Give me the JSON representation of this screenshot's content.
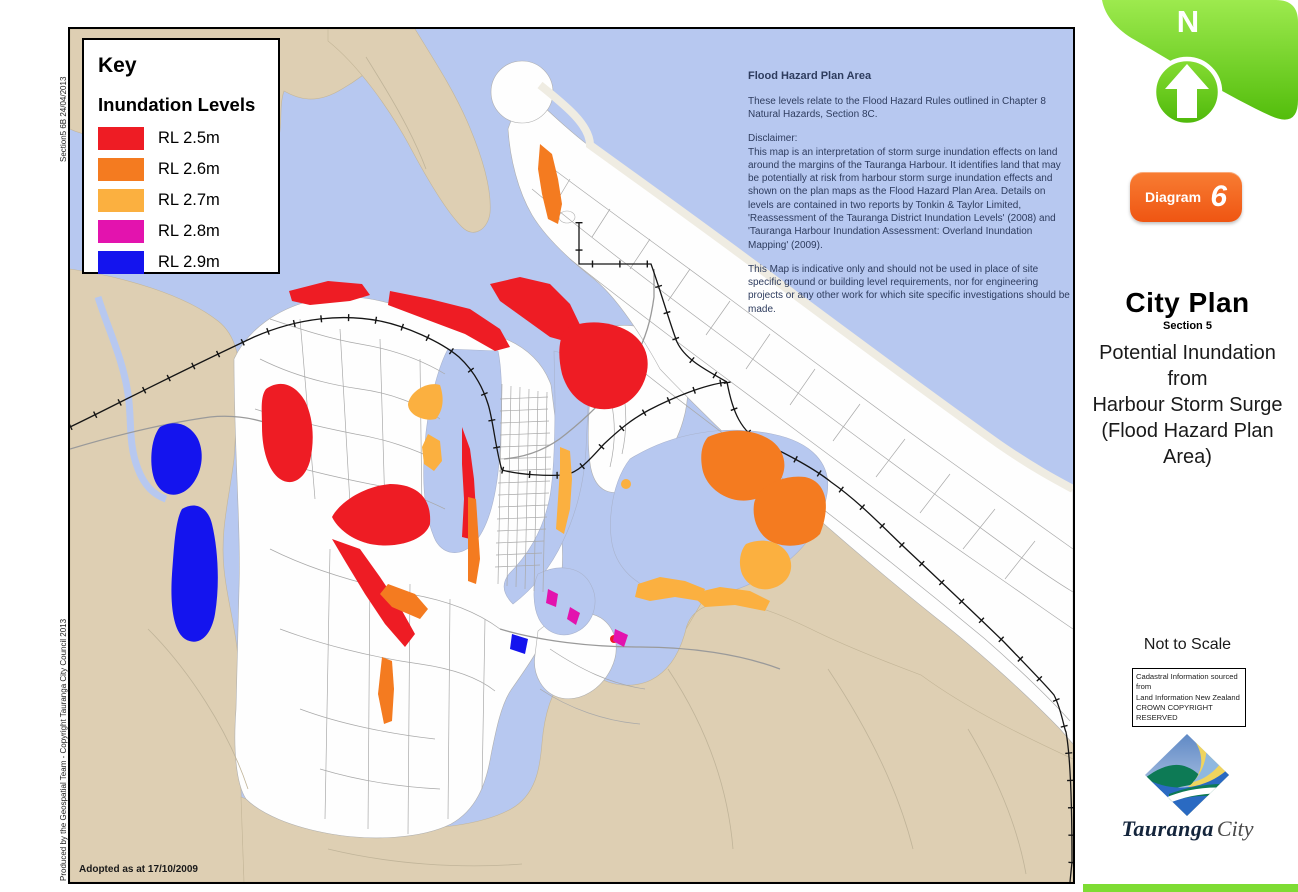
{
  "page": {
    "background": "#ffffff",
    "side_note_top": "Section5 6B 24/04/2013",
    "side_note_bottom": "Produced by the Geospatial Team - Copyright Tauranga City Council 2013"
  },
  "map": {
    "adopted_label": "Adopted as at 17/10/2009",
    "colors": {
      "water": "#b7c8f0",
      "land": "#decfb3",
      "urban": "#fefefe",
      "roads": "#a9a9a9",
      "railway": "#151515"
    }
  },
  "key": {
    "title": "Key",
    "subtitle": "Inundation Levels",
    "items": [
      {
        "label": "RL 2.5m",
        "color": "#ee1c24"
      },
      {
        "label": "RL 2.6m",
        "color": "#f47b20"
      },
      {
        "label": "RL 2.7m",
        "color": "#fbb040"
      },
      {
        "label": "RL 2.8m",
        "color": "#e313ae"
      },
      {
        "label": "RL 2.9m",
        "color": "#1414ee"
      }
    ]
  },
  "notes": {
    "heading": "Flood Hazard Plan Area",
    "para1": "These levels relate to the Flood Hazard Rules outlined in Chapter 8 Natural Hazards, Section 8C.",
    "disclaimer_label": "Disclaimer:",
    "para2": "This map is an interpretation of storm surge inundation effects on land around the margins of the Tauranga Harbour.  It identifies land that may be potentially at risk from harbour storm surge inundation effects and shown on the plan maps as the Flood Hazard Plan Area. Details on levels are contained in two reports by Tonkin & Taylor Limited, 'Reassessment of the Tauranga District Inundation Levels' (2008) and 'Tauranga Harbour Inundation Assessment: Overland Inundation Mapping' (2009).",
    "para3": "This Map is indicative only and should not be used in place of site specific ground or building level requirements, nor for engineering projects or any other work for which site specific investigations should be made."
  },
  "sidebar": {
    "north_label": "N",
    "diagram_label": "Diagram",
    "diagram_number": "6",
    "plan_title": "City Plan",
    "plan_section": "Section 5",
    "subtitle_lines": [
      "Potential Inundation",
      "from",
      "Harbour Storm Surge",
      "(Flood Hazard Plan Area)"
    ],
    "scale_note": "Not to Scale",
    "cadastral_lines": [
      "Cadastral Information sourced from",
      "Land Information New Zealand",
      "CROWN COPYRIGHT RESERVED"
    ],
    "logo_name": "Tauranga",
    "logo_suffix": "City",
    "accent_green": "#63c813",
    "accent_orange": "#f15a22"
  }
}
